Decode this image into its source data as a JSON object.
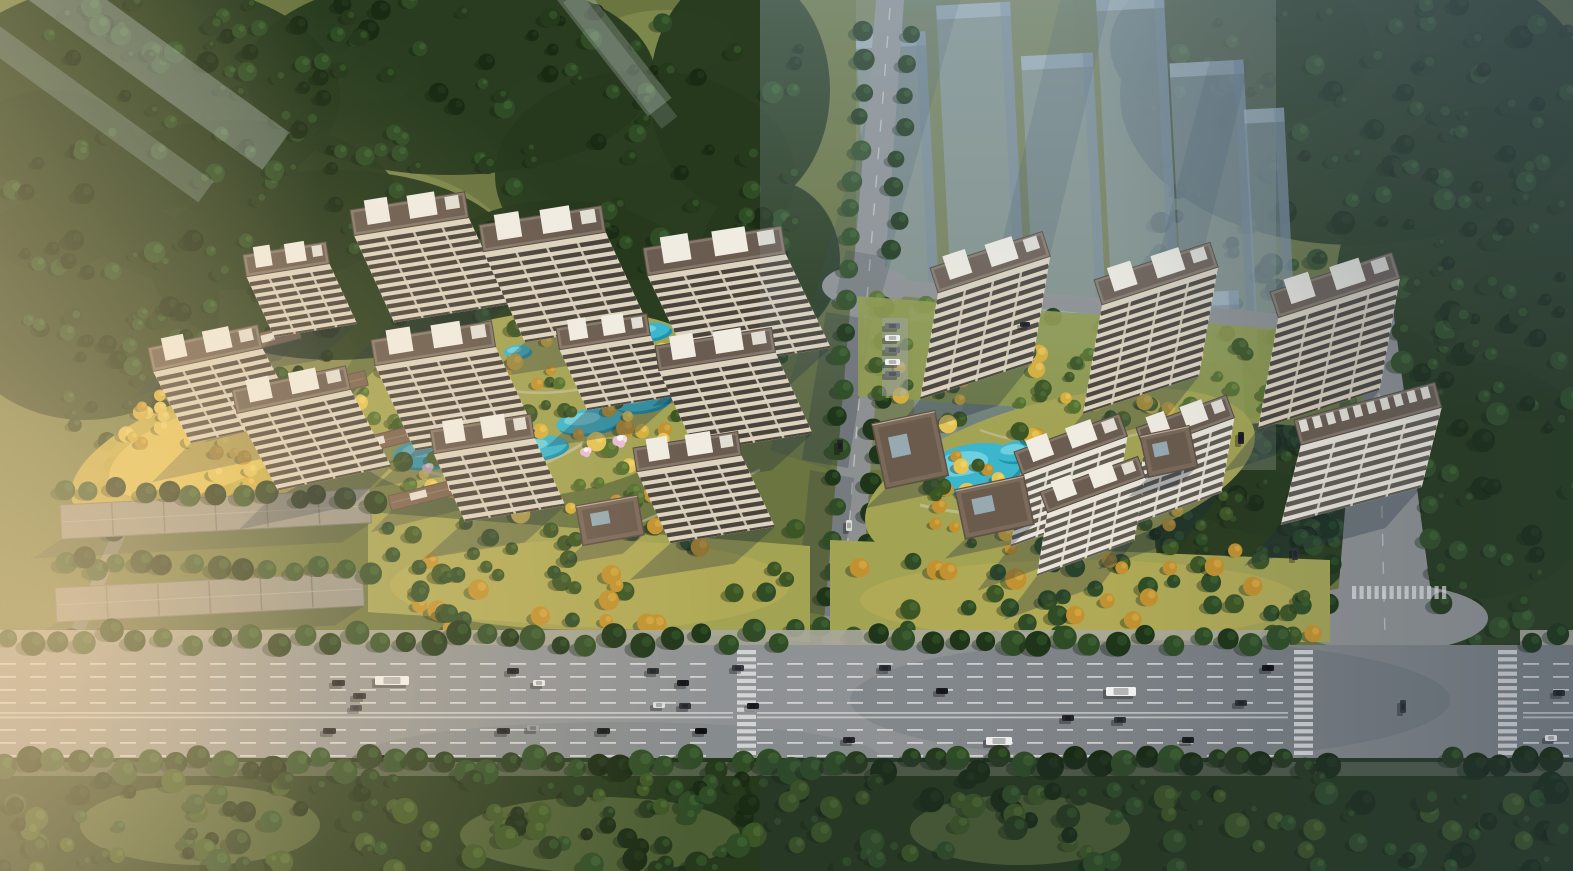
{
  "scene": {
    "title": "Aerial rendering of a twin-compound residential development between forest land and an eight-lane highway",
    "view": "high oblique bird's-eye view",
    "lighting": "afternoon sun from the upper right, warm golden haze in the lower-left corner, cool blue haze over the upper right",
    "west_compound": {
      "label": "west residential compound",
      "towers": 11,
      "lowrise_terrace_rows": 4,
      "water_garden_ponds": 10,
      "blossom_tree_clusters": 6,
      "entrance_pavilions": 1
    },
    "east_compound": {
      "label": "east residential compound",
      "towers": 7,
      "clubhouse_pavilions": 3,
      "swimming_pool": true,
      "blossom_tree_clusters": 6,
      "parking_bay_cars": 5
    },
    "surroundings": {
      "forest": "dense dark-green woodland with olive clearings on the upper left, upper right and below the highway",
      "future_phase": "translucent blue-gray building massing in the upper right",
      "existing_gray_slab_buildings": 2,
      "south_belt": "street tree belt and lawns below the highway"
    },
    "highway": {
      "orientation": "horizontal across the lower third",
      "carriageways": 2,
      "dashed_lane_lines": 7,
      "pedestrian_crossings": 5,
      "signalized_intersection": true
    },
    "roads": [
      "west-lane",
      "center-avenue",
      "north-access-road",
      "east-avenue"
    ],
    "vehicles_total": 44
  },
  "palette": {
    "field": "#6a7540",
    "field_light": "#7e8a4c",
    "field_warm": "#8b8b52",
    "forest": "#26391d",
    "forest_deep": "#1a2b14",
    "forest_mid": "#2f4c26",
    "tree_hi": "#3f6231",
    "row_tree": "#1e3519",
    "row_hi": "#2c4f24",
    "lawn": "#a3a354",
    "lawn_gold": "#cfb547",
    "gold1": "#d5af3d",
    "gold2": "#c1922f",
    "gold3": "#e3c455",
    "garden_green": "#55702f",
    "garden_dark": "#3c5524",
    "road": "#8d9091",
    "road_worn": "#8b8d7f",
    "asphalt": "#8f9294",
    "sidewalk": "#a9a79b",
    "lane": "#ededed",
    "facade": "#ddd3bf",
    "stripe": "#4a443c",
    "fac_white": "#e9e5da",
    "stripe_soft": "#625c52",
    "roof": "#85786b",
    "roof_inner": "#6a5c50",
    "roof_edge": "#544a3f",
    "pent": "#f0ece2",
    "lowrise_roof": "#7a6150",
    "gray_roof": "#96948a",
    "gray_roof_dark": "#75746b",
    "pav_roof": "#7b695a",
    "pav_dark": "#5e5044",
    "pool": "#3cb6cc",
    "pool_deep": "#1f93ad",
    "pool_hi": "#90e0ea",
    "blossom": "#e9bcd8",
    "blossom_hi": "#f5d9e9",
    "ghost": "#8ea1b5",
    "ghost_light": "#aebfcd",
    "ghost_dark": "#74879b",
    "shadow": "#1c2a3a",
    "warm": "#ffd9a2",
    "warm_left": "#f6d7a6",
    "fog": "#e8eef2",
    "haze": "#a9c0d6",
    "cool": "#33475e",
    "car_dark": "#1d2126",
    "car_white": "#f2f2f0",
    "car_gray": "#6e7277",
    "car_red": "#8a2424"
  }
}
